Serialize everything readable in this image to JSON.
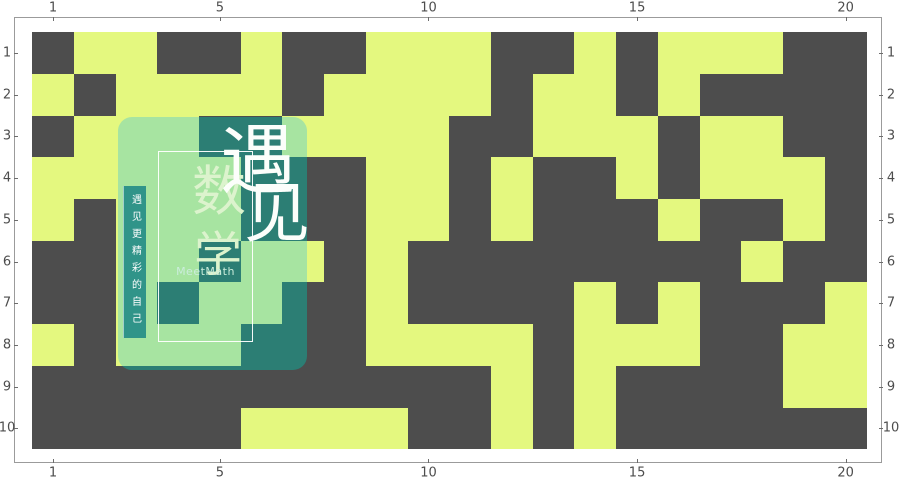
{
  "chart_data": {
    "type": "heatmap",
    "title": "",
    "xlabel": "",
    "ylabel": "",
    "rows": 10,
    "cols": 20,
    "x_tick_labels": [
      "1",
      "5",
      "10",
      "15",
      "20"
    ],
    "x_tick_cols": [
      1,
      5,
      10,
      15,
      20
    ],
    "y_tick_labels": [
      "1",
      "2",
      "3",
      "4",
      "5",
      "6",
      "7",
      "8",
      "9",
      "10"
    ],
    "y_tick_rows": [
      1,
      2,
      3,
      4,
      5,
      6,
      7,
      8,
      9,
      10
    ],
    "legend": "none",
    "gridlines": "off",
    "value_colors": {
      "1": "#e4f87f",
      "0": "#4d4d4d"
    },
    "matrix": [
      [
        0,
        1,
        1,
        0,
        0,
        1,
        0,
        0,
        1,
        1,
        1,
        0,
        0,
        1,
        0,
        1,
        1,
        1,
        0,
        0
      ],
      [
        1,
        0,
        1,
        1,
        1,
        1,
        0,
        1,
        1,
        1,
        1,
        0,
        1,
        1,
        0,
        1,
        0,
        0,
        0,
        0
      ],
      [
        0,
        1,
        1,
        1,
        0,
        0,
        1,
        1,
        1,
        1,
        0,
        0,
        1,
        1,
        1,
        0,
        1,
        1,
        0,
        0
      ],
      [
        1,
        1,
        1,
        1,
        1,
        0,
        0,
        0,
        1,
        1,
        0,
        1,
        0,
        0,
        1,
        0,
        1,
        1,
        1,
        0
      ],
      [
        1,
        0,
        1,
        1,
        1,
        0,
        0,
        0,
        1,
        1,
        0,
        1,
        0,
        0,
        0,
        1,
        0,
        0,
        1,
        0
      ],
      [
        0,
        0,
        1,
        1,
        0,
        1,
        1,
        0,
        1,
        0,
        0,
        0,
        0,
        0,
        0,
        0,
        0,
        1,
        0,
        0
      ],
      [
        0,
        0,
        1,
        0,
        1,
        1,
        0,
        0,
        1,
        0,
        0,
        0,
        0,
        1,
        0,
        1,
        0,
        0,
        0,
        1
      ],
      [
        1,
        0,
        1,
        1,
        1,
        0,
        0,
        0,
        1,
        1,
        1,
        1,
        0,
        1,
        1,
        1,
        0,
        0,
        1,
        1
      ],
      [
        0,
        0,
        0,
        0,
        0,
        0,
        0,
        0,
        0,
        0,
        0,
        1,
        0,
        1,
        0,
        0,
        0,
        0,
        1,
        1
      ],
      [
        0,
        0,
        0,
        0,
        0,
        1,
        1,
        1,
        1,
        0,
        0,
        1,
        0,
        1,
        0,
        0,
        0,
        0,
        0,
        0
      ]
    ]
  },
  "watermark": {
    "banner_text": "遇见更精彩的自己",
    "char_yu": "遇",
    "char_jian": "见",
    "char_shu": "数",
    "char_xue": "学",
    "brand_text": "MeetMath",
    "overlay_light": "#a7e4a1",
    "overlay_dark": "#2c7e74",
    "banner_color": "#309489"
  }
}
